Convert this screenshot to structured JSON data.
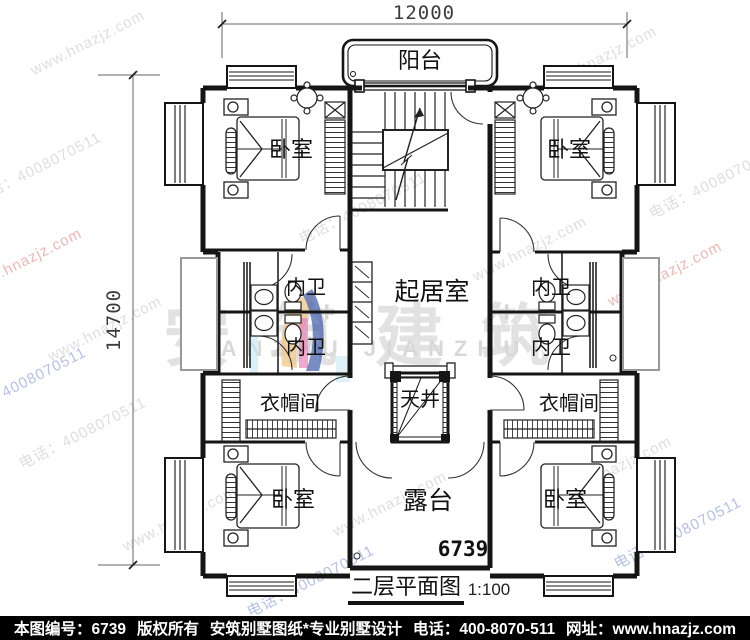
{
  "meta": {
    "title": "二层平面图",
    "scale": "1:100",
    "plan_number": "6739"
  },
  "dimensions": {
    "width_mm": "12000",
    "height_mm": "14700"
  },
  "rooms": {
    "balcony": "阳台",
    "bedroom": "卧室",
    "inner_bath": "内卫",
    "living": "起居室",
    "cloakroom": "衣帽间",
    "lightwell": "天井",
    "terrace": "露台"
  },
  "watermark": {
    "site": "www.hnazjz.com",
    "phone_diag": "电话：4008070511",
    "brand_cn": "安筑建筑",
    "brand_en": "ANZHU  JIANZHU",
    "plus": "+",
    "color_gray": "#dedede",
    "color_red": "#efb6b6",
    "color_blue": "#b6c0e6"
  },
  "footer": {
    "number_label": "本图编号：6739",
    "copyright": "版权所有",
    "studio": "安筑别墅图纸*专业别墅设计",
    "phone": "电话：400-8070-511",
    "site": "网址：www.hnazjz.com"
  }
}
